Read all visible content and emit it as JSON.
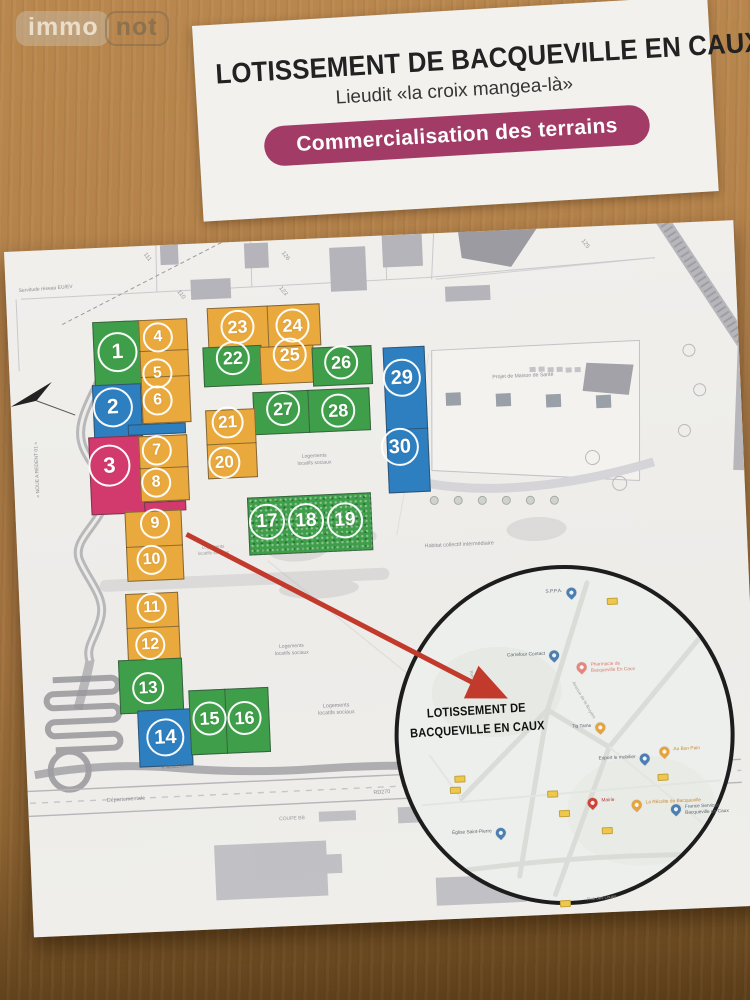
{
  "watermark": {
    "part1": "immo",
    "part2": "not"
  },
  "flyer": {
    "title": "LOTISSEMENT DE BACQUEVILLE EN CAUX",
    "subtitle": "Lieudit «la croix mangea-là»",
    "banner": "Commercialisation des terrains",
    "banner_color": "#a23c67"
  },
  "plan": {
    "palette": {
      "green": "#3f9e4a",
      "orange": "#e9a93c",
      "blue": "#2d7fc0",
      "pink": "#d23a6e",
      "line": "rgba(45,45,50,0.5)"
    },
    "lots": [
      {
        "n": "1",
        "color": "green",
        "x": 109,
        "y": 105,
        "s": 40
      },
      {
        "n": "2",
        "color": "blue",
        "x": 102,
        "y": 160,
        "s": 40
      },
      {
        "n": "3",
        "color": "pink",
        "x": 96,
        "y": 218,
        "s": 42
      },
      {
        "n": "4",
        "color": "orange",
        "x": 150,
        "y": 92,
        "s": 30
      },
      {
        "n": "5",
        "color": "orange",
        "x": 148,
        "y": 128,
        "s": 30
      },
      {
        "n": "6",
        "color": "orange",
        "x": 147,
        "y": 155,
        "s": 30
      },
      {
        "n": "7",
        "color": "orange",
        "x": 144,
        "y": 205,
        "s": 30
      },
      {
        "n": "8",
        "color": "orange",
        "x": 142,
        "y": 237,
        "s": 30
      },
      {
        "n": "9",
        "color": "orange",
        "x": 139,
        "y": 278,
        "s": 30
      },
      {
        "n": "10",
        "color": "orange",
        "x": 134,
        "y": 314,
        "s": 30
      },
      {
        "n": "11",
        "color": "orange",
        "x": 132,
        "y": 362,
        "s": 30
      },
      {
        "n": "12",
        "color": "orange",
        "x": 129,
        "y": 399,
        "s": 30
      },
      {
        "n": "13",
        "color": "green",
        "x": 125,
        "y": 442,
        "s": 32
      },
      {
        "n": "14",
        "color": "blue",
        "x": 140,
        "y": 492,
        "s": 38
      },
      {
        "n": "15",
        "color": "green",
        "x": 185,
        "y": 475,
        "s": 34
      },
      {
        "n": "16",
        "color": "green",
        "x": 220,
        "y": 476,
        "s": 34
      },
      {
        "n": "17",
        "color": "green",
        "x": 251,
        "y": 281,
        "s": 36
      },
      {
        "n": "18",
        "color": "green",
        "x": 290,
        "y": 282,
        "s": 36
      },
      {
        "n": "19",
        "color": "green",
        "x": 329,
        "y": 283,
        "s": 36
      },
      {
        "n": "20",
        "color": "orange",
        "x": 211,
        "y": 220,
        "s": 32
      },
      {
        "n": "21",
        "color": "orange",
        "x": 216,
        "y": 180,
        "s": 32
      },
      {
        "n": "22",
        "color": "green",
        "x": 224,
        "y": 116,
        "s": 34
      },
      {
        "n": "23",
        "color": "orange",
        "x": 230,
        "y": 85,
        "s": 34
      },
      {
        "n": "24",
        "color": "orange",
        "x": 285,
        "y": 86,
        "s": 34
      },
      {
        "n": "25",
        "color": "orange",
        "x": 281,
        "y": 115,
        "s": 34
      },
      {
        "n": "26",
        "color": "green",
        "x": 332,
        "y": 125,
        "s": 34
      },
      {
        "n": "27",
        "color": "green",
        "x": 272,
        "y": 169,
        "s": 34
      },
      {
        "n": "28",
        "color": "green",
        "x": 327,
        "y": 173,
        "s": 34
      },
      {
        "n": "29",
        "color": "blue",
        "x": 392,
        "y": 143,
        "s": 38
      },
      {
        "n": "30",
        "color": "blue",
        "x": 387,
        "y": 212,
        "s": 38
      }
    ],
    "blocks": [
      {
        "x": 85,
        "y": 74,
        "w": 49,
        "h": 68,
        "color": "green"
      },
      {
        "x": 82,
        "y": 137,
        "w": 49,
        "h": 55,
        "color": "blue"
      },
      {
        "x": 116,
        "y": 178,
        "w": 58,
        "h": 11,
        "color": "blue"
      },
      {
        "x": 76,
        "y": 189,
        "w": 54,
        "h": 78,
        "color": "pink"
      },
      {
        "x": 129,
        "y": 256,
        "w": 42,
        "h": 10,
        "color": "pink"
      },
      {
        "x": 131,
        "y": 74,
        "w": 49,
        "h": 104,
        "color": "orange"
      },
      {
        "x": 126,
        "y": 190,
        "w": 49,
        "h": 66,
        "color": "orange"
      },
      {
        "x": 109,
        "y": 265,
        "w": 57,
        "h": 70,
        "color": "orange"
      },
      {
        "x": 106,
        "y": 347,
        "w": 53,
        "h": 68,
        "color": "orange"
      },
      {
        "x": 96,
        "y": 413,
        "w": 64,
        "h": 54,
        "color": "green"
      },
      {
        "x": 113,
        "y": 464,
        "w": 54,
        "h": 57,
        "color": "blue"
      },
      {
        "x": 165,
        "y": 446,
        "w": 80,
        "h": 65,
        "color": "green"
      },
      {
        "x": 200,
        "y": 65,
        "w": 113,
        "h": 42,
        "color": "orange"
      },
      {
        "x": 194,
        "y": 104,
        "w": 59,
        "h": 40,
        "color": "green"
      },
      {
        "x": 251,
        "y": 106,
        "w": 54,
        "h": 38,
        "color": "orange"
      },
      {
        "x": 303,
        "y": 109,
        "w": 60,
        "h": 39,
        "color": "green"
      },
      {
        "x": 242,
        "y": 151,
        "w": 117,
        "h": 43,
        "color": "green"
      },
      {
        "x": 194,
        "y": 167,
        "w": 50,
        "h": 69,
        "color": "orange"
      },
      {
        "x": 374,
        "y": 112,
        "w": 42,
        "h": 146,
        "color": "blue"
      },
      {
        "x": 232,
        "y": 256,
        "w": 124,
        "h": 58,
        "color": "green",
        "tex": true
      },
      {
        "x": 131,
        "y": 105,
        "w": 49,
        "h": 1,
        "color": "line"
      },
      {
        "x": 131,
        "y": 131,
        "w": 49,
        "h": 1,
        "color": "line"
      },
      {
        "x": 126,
        "y": 222,
        "w": 49,
        "h": 1,
        "color": "line"
      },
      {
        "x": 109,
        "y": 300,
        "w": 57,
        "h": 1,
        "color": "line"
      },
      {
        "x": 106,
        "y": 381,
        "w": 53,
        "h": 1,
        "color": "line"
      },
      {
        "x": 260,
        "y": 65,
        "w": 1,
        "h": 42,
        "color": "line"
      },
      {
        "x": 297,
        "y": 151,
        "w": 1,
        "h": 43,
        "color": "line"
      },
      {
        "x": 194,
        "y": 201,
        "w": 50,
        "h": 1,
        "color": "line"
      },
      {
        "x": 201,
        "y": 446,
        "w": 1,
        "h": 65,
        "color": "line"
      },
      {
        "x": 374,
        "y": 194,
        "w": 42,
        "h": 1,
        "color": "line"
      }
    ],
    "labels": [
      {
        "t": "Servitude réseau EU/EV",
        "x": 40,
        "y": 39,
        "s": 5,
        "r": -2
      },
      {
        "t": "« NOUE A REDENT 01 »",
        "x": 24,
        "y": 219,
        "s": 5,
        "r": -90
      },
      {
        "t": "111",
        "x": 142,
        "y": 12,
        "s": 6,
        "r": 55,
        "c": "#98989e"
      },
      {
        "t": "126",
        "x": 280,
        "y": 17,
        "s": 6,
        "r": 55,
        "c": "#98989e"
      },
      {
        "t": "110",
        "x": 174,
        "y": 51,
        "s": 6,
        "r": 55,
        "c": "#98989e"
      },
      {
        "t": "123",
        "x": 276,
        "y": 52,
        "s": 6,
        "r": 55,
        "c": "#98989e"
      },
      {
        "t": "125",
        "x": 580,
        "y": 18,
        "s": 6,
        "r": 55,
        "c": "#98989e"
      },
      {
        "t": "Projet de Maison de Santé",
        "x": 513,
        "y": 147,
        "s": 5.2
      },
      {
        "t": "Logements\nlocatifs sociaux",
        "x": 301,
        "y": 221,
        "s": 5
      },
      {
        "t": "Logements\nlocatifs sociaux",
        "x": 196,
        "y": 307,
        "s": 4.6,
        "c": "#9a9aa0"
      },
      {
        "t": "Logements\nlocatifs sociaux",
        "x": 270,
        "y": 410,
        "s": 5
      },
      {
        "t": "Logements\nlocatifs sociaux",
        "x": 312,
        "y": 472,
        "s": 5.4
      },
      {
        "t": "Habitat collectif intermédiaire",
        "x": 442,
        "y": 313,
        "s": 5.4
      },
      {
        "t": "« NOUE A »",
        "x": 148,
        "y": 523,
        "s": 4.8,
        "r": -2,
        "c": "#77777d"
      },
      {
        "t": "Départementale",
        "x": 98,
        "y": 553,
        "s": 5.4,
        "r": -1
      },
      {
        "t": "RD270",
        "x": 354,
        "y": 557,
        "s": 5.4,
        "r": -2
      },
      {
        "t": "Gruchet-Saint-Siméon",
        "x": 552,
        "y": 551,
        "s": 5.4,
        "r": -3
      },
      {
        "t": "COUPE BB",
        "x": 263,
        "y": 579,
        "s": 5,
        "c": "#9a9aa0"
      }
    ]
  },
  "map_inset": {
    "title_line1": "LOTISSEMENT DE",
    "title_line2": "BACQUEVILLE EN CAUX",
    "title_x": 452,
    "title_y": 489,
    "pins": [
      {
        "label": "S.P.P.A.",
        "color": "blue",
        "x": 552,
        "y": 371,
        "side": "left"
      },
      {
        "label": "Carrefour Contact",
        "color": "blue",
        "x": 532,
        "y": 433,
        "side": "left"
      },
      {
        "label": "Pharmacie de Bacqueville En Caux",
        "color": "salmon",
        "x": 559,
        "y": 446,
        "side": "right",
        "lcolor": "#dd7b6e",
        "two": true
      },
      {
        "label": "Tiq Tame",
        "color": "orange",
        "x": 575,
        "y": 507,
        "side": "left"
      },
      {
        "label": "Export le mobilier",
        "color": "blue",
        "x": 618,
        "y": 540,
        "side": "left"
      },
      {
        "label": "Au Bon Pain",
        "color": "orange",
        "x": 638,
        "y": 534,
        "side": "right",
        "lcolor": "#c98a2e"
      },
      {
        "label": "Mairie",
        "color": "red",
        "x": 564,
        "y": 582,
        "side": "right",
        "lcolor": "#b33a33"
      },
      {
        "label": "La Récolte de Bacqueville",
        "color": "orange",
        "x": 608,
        "y": 586,
        "side": "right",
        "lcolor": "#c98a2e"
      },
      {
        "label": "France Services Bacqueville en Caux",
        "color": "blue",
        "x": 647,
        "y": 592,
        "side": "right",
        "two": true
      },
      {
        "label": "Église Saint-Pierre",
        "color": "blue",
        "x": 471,
        "y": 608,
        "side": "left"
      }
    ],
    "shields": [
      {
        "x": 587,
        "y": 372
      },
      {
        "x": 427,
        "y": 543
      },
      {
        "x": 422,
        "y": 554
      },
      {
        "x": 519,
        "y": 562
      },
      {
        "x": 530,
        "y": 582
      },
      {
        "x": 572,
        "y": 601
      },
      {
        "x": 630,
        "y": 550
      },
      {
        "x": 527,
        "y": 672
      }
    ],
    "streets": [
      {
        "t": "Rue des Loups",
        "x": 569,
        "y": 671,
        "r": -3
      },
      {
        "t": "Avenue de la Bruyère",
        "x": 560,
        "y": 473,
        "r": 62
      },
      {
        "t": "Rue du Val",
        "x": 451,
        "y": 449,
        "r": 75
      }
    ]
  }
}
